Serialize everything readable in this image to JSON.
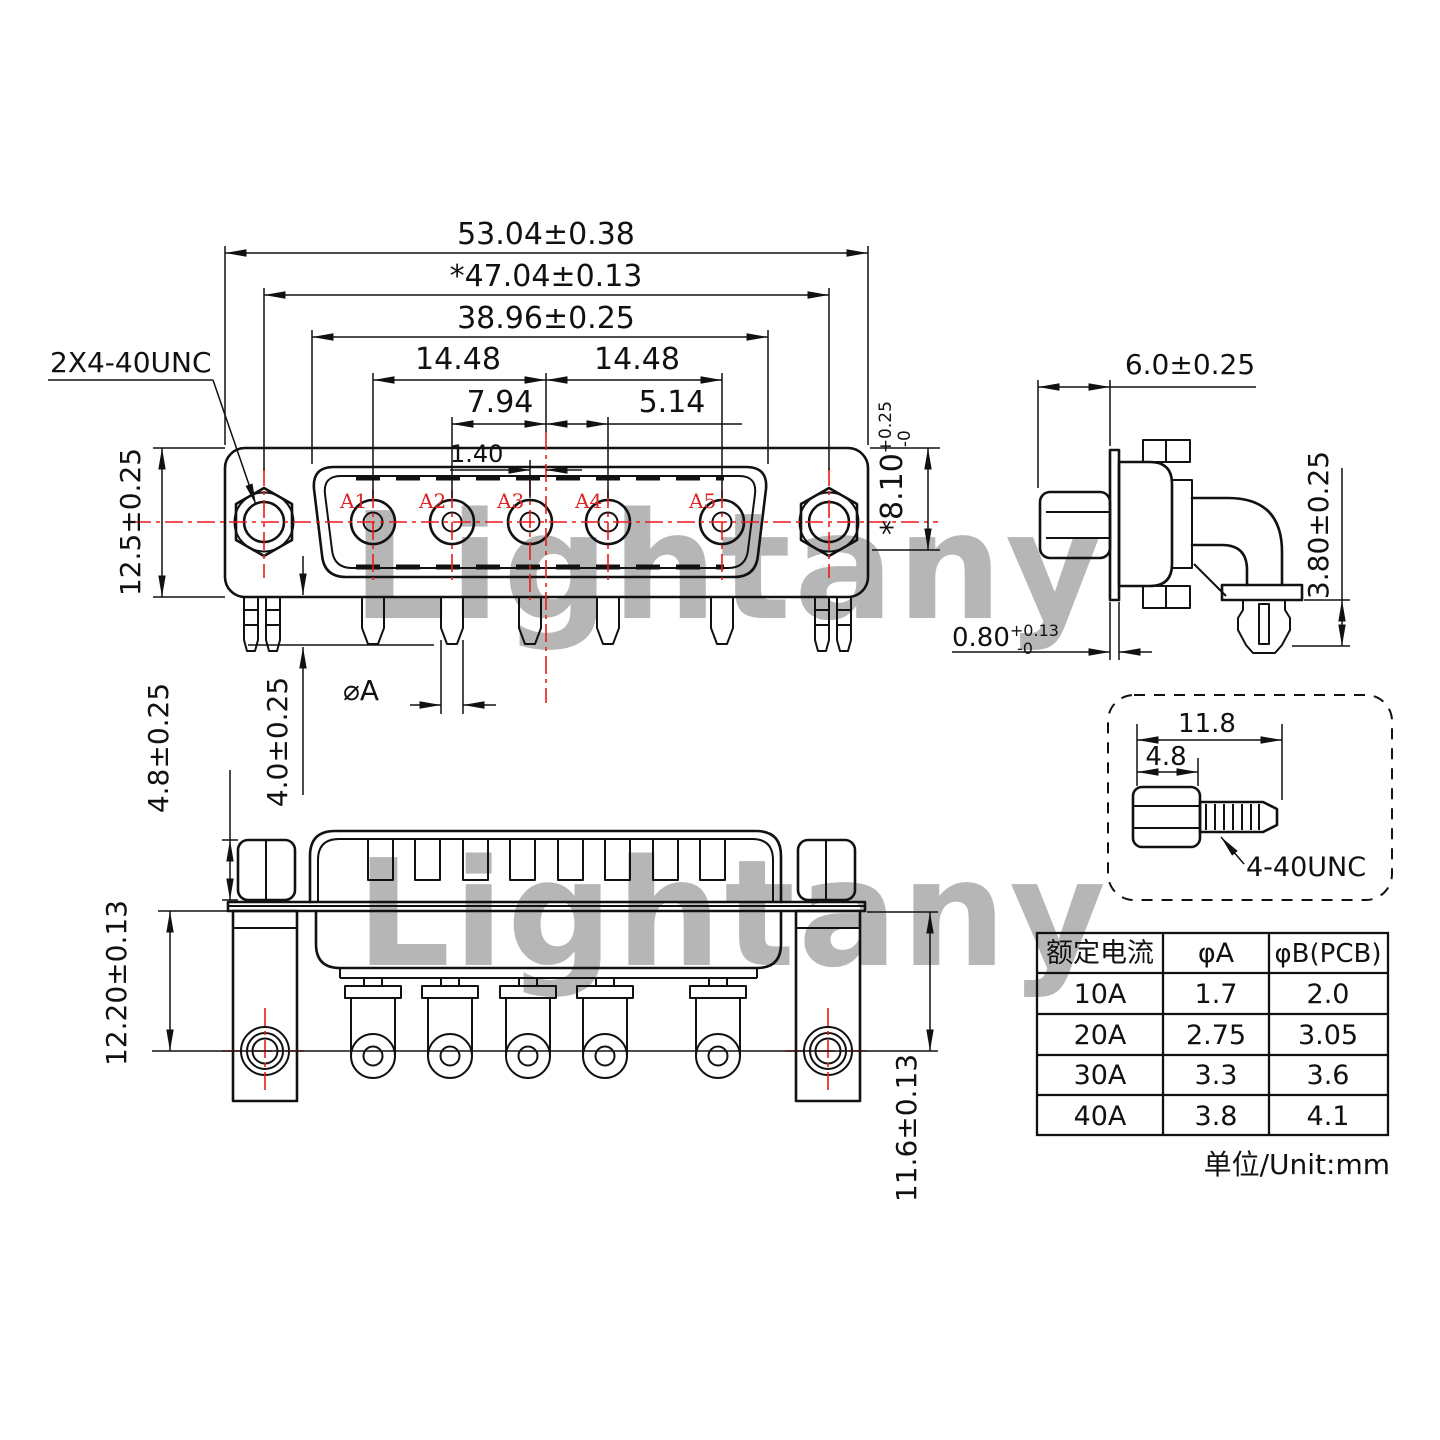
{
  "watermark": {
    "text": "Lightany",
    "color": "#ef9f9f"
  },
  "front_view": {
    "thread_callout": "2X4-40UNC",
    "pin_labels": [
      "A1",
      "A2",
      "A3",
      "A4",
      "A5"
    ],
    "dims": {
      "overall_width": "53.04±0.38",
      "mounting_span": "*47.04±0.13",
      "shell_width": "38.96±0.25",
      "pitch_left": "14.48",
      "pitch_right": "14.48",
      "pitch_a2": "7.94",
      "pitch_a4": "5.14",
      "pitch_a3_offset": "1.40",
      "body_height": "12.5±0.25",
      "shell_depth": "*8.10",
      "shell_depth_tol_plus": "+0.25",
      "shell_depth_tol_minus": "-0",
      "pin_length": "4.0±0.25",
      "pin_diameter": "⌀A"
    }
  },
  "side_view": {
    "dims": {
      "front_depth": "6.0±0.25",
      "pin_below_bracket": "3.80±0.25",
      "flange_thickness": "0.80",
      "flange_tol_plus": "+0.13",
      "flange_tol_minus": "-0"
    }
  },
  "bottom_view": {
    "dims": {
      "standoff_height": "4.8±0.25",
      "hole_to_plate_left": "12.20±0.13",
      "hole_to_plate_right": "11.6±0.13"
    }
  },
  "screw_detail": {
    "dims": {
      "total_length": "11.8",
      "head_length": "4.8"
    },
    "thread_callout": "4-40UNC"
  },
  "spec_table": {
    "headers": [
      "额定电流",
      "φA",
      "φB(PCB)"
    ],
    "rows": [
      [
        "10A",
        "1.7",
        "2.0"
      ],
      [
        "20A",
        "2.75",
        "3.05"
      ],
      [
        "30A",
        "3.3",
        "3.6"
      ],
      [
        "40A",
        "3.8",
        "4.1"
      ]
    ],
    "unit_note": "单位/Unit:mm"
  },
  "colors": {
    "line": "#111111",
    "centerline": "#f01818",
    "pin_label": "#e02424",
    "background": "#ffffff"
  }
}
